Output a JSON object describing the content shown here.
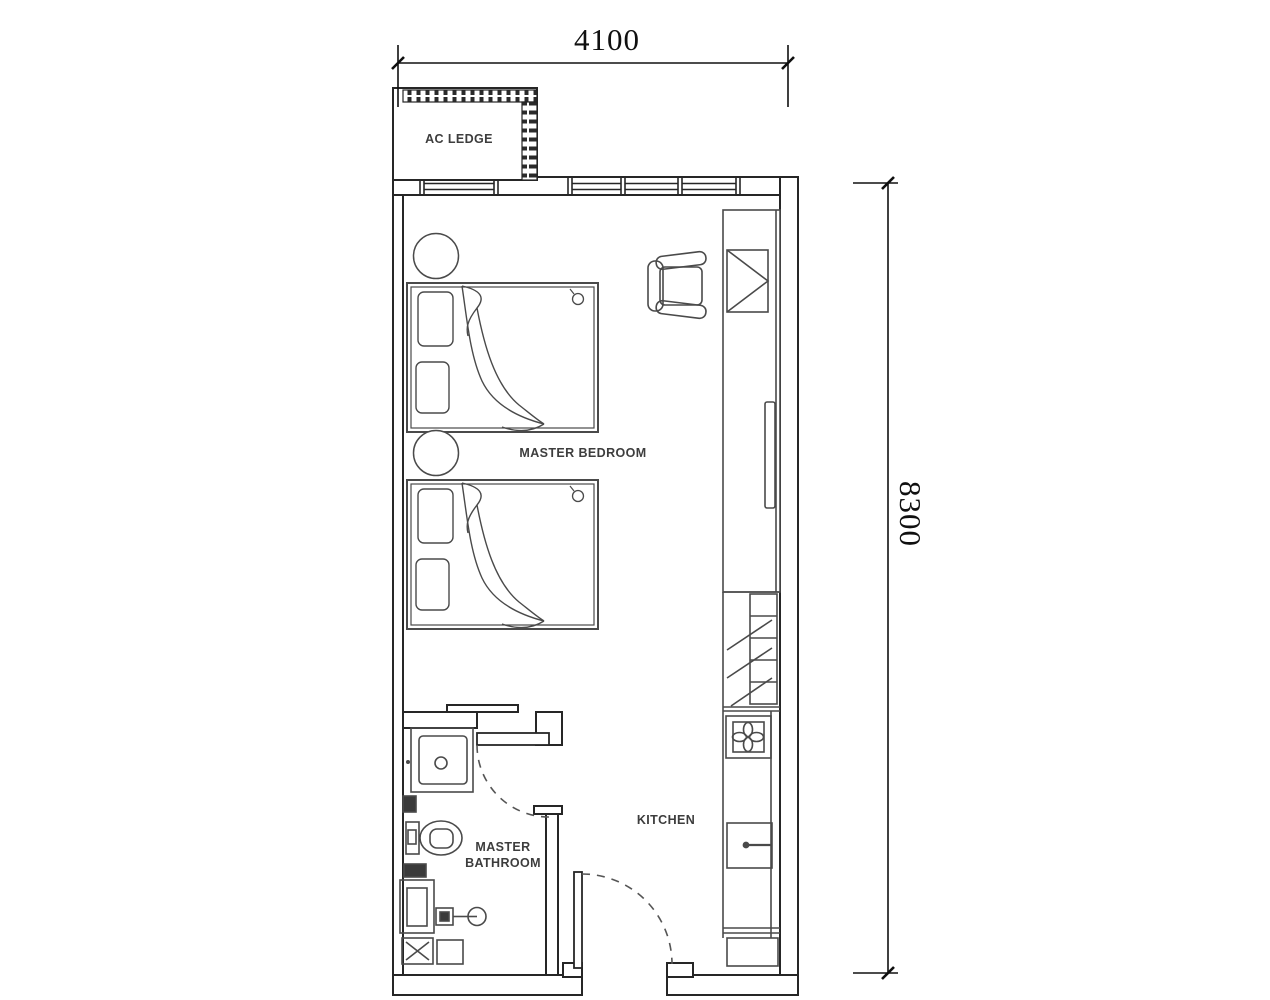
{
  "plan": {
    "title": "Apartment unit floor plan",
    "labels": {
      "ac_ledge": "AC LEDGE",
      "master_bedroom": "MASTER BEDROOM",
      "master_bathroom_line1": "MASTER",
      "master_bathroom_line2": "BATHROOM",
      "kitchen": "KITCHEN"
    },
    "dimensions": {
      "width_mm": "4100",
      "height_mm": "8300"
    },
    "furniture": [
      {
        "name": "ac-ledge",
        "room": "exterior"
      },
      {
        "name": "window-band",
        "room": "master-bedroom"
      },
      {
        "name": "single-bed-1",
        "room": "master-bedroom"
      },
      {
        "name": "single-bed-2",
        "room": "master-bedroom"
      },
      {
        "name": "bedside-table-1",
        "room": "master-bedroom"
      },
      {
        "name": "bedside-table-2",
        "room": "master-bedroom"
      },
      {
        "name": "armchair",
        "room": "master-bedroom"
      },
      {
        "name": "wardrobe-with-swing-door",
        "room": "master-bedroom"
      },
      {
        "name": "tall-cabinet-fridge",
        "room": "kitchen"
      },
      {
        "name": "cooker-hob",
        "room": "kitchen"
      },
      {
        "name": "kitchen-sink",
        "room": "kitchen"
      },
      {
        "name": "base-cabinet",
        "room": "kitchen"
      },
      {
        "name": "vanity-basin",
        "room": "master-bathroom"
      },
      {
        "name": "toilet",
        "room": "master-bathroom"
      },
      {
        "name": "shower-head",
        "room": "master-bathroom"
      },
      {
        "name": "floor-trap",
        "room": "master-bathroom"
      },
      {
        "name": "bathroom-door-swing",
        "room": "master-bathroom"
      },
      {
        "name": "entrance-door-swing",
        "room": "kitchen"
      }
    ],
    "colors": {
      "background": "#ffffff",
      "wall_line": "#262626",
      "furniture_line": "#4a4a4a",
      "text": "#3d3d3d",
      "dimension_line": "#101010"
    }
  }
}
